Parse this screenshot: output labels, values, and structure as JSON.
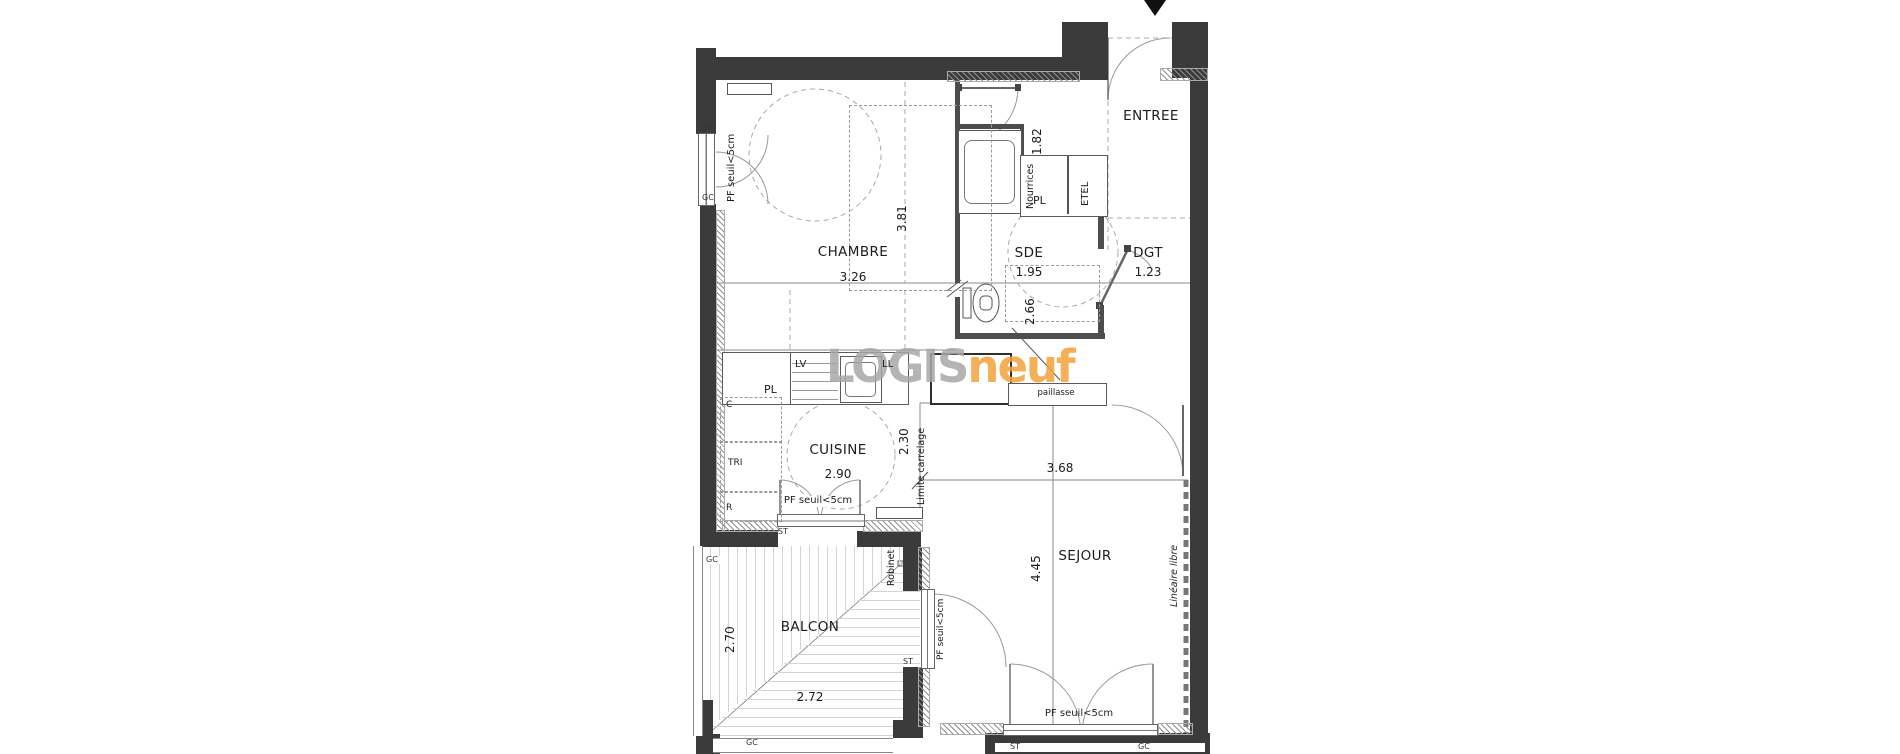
{
  "logo": {
    "text_gray": "LOGIS",
    "text_orange": "neuf",
    "color_gray": "#a7a7a7",
    "color_orange": "#f1a33b"
  },
  "marker": {
    "entrance_arrow": "black-down-triangle"
  },
  "rooms": {
    "entree": {
      "name": "ENTREE"
    },
    "chambre": {
      "name": "CHAMBRE",
      "w": "3.26",
      "h": "3.81"
    },
    "sde": {
      "name": "SDE",
      "w": "1.95",
      "h": "2.66"
    },
    "dgt": {
      "name": "DGT",
      "w": "1.23"
    },
    "cuisine": {
      "name": "CUISINE",
      "w": "2.90",
      "h": "2.30"
    },
    "sejour": {
      "name": "SEJOUR",
      "w": "3.68",
      "h": "4.45"
    },
    "balcon": {
      "name": "BALCON",
      "w": "2.72",
      "h": "2.70"
    }
  },
  "labels": {
    "nourrices": "Nourrices",
    "nourrices_dim": "1.82",
    "pl": "PL",
    "etel": "ETEL",
    "lv": "LV",
    "ll": "LL",
    "paillasse": "paillasse",
    "limite_carrelage": "Limite carrelage",
    "lineaire_libre": "Linéaire libre",
    "robinet": "Robinet",
    "pf": "PF seuil<5cm",
    "c": "C",
    "tri": "TRI",
    "r": "R",
    "st": "ST",
    "gc": "GC"
  }
}
